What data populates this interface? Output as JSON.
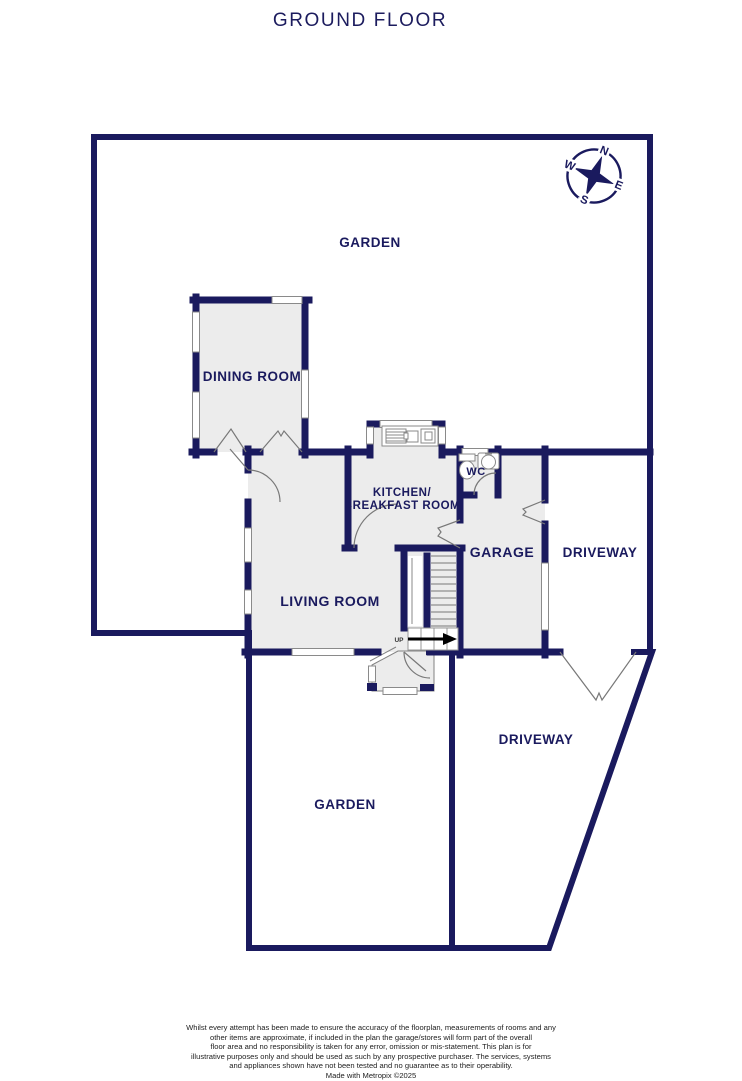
{
  "title": "GROUND FLOOR",
  "colors": {
    "wall": "#1a1a5e",
    "room_fill": "#ececec",
    "thin_line": "#828282",
    "label": "#1a1a5e",
    "arrow": "#000000"
  },
  "compass": {
    "north": "N",
    "east": "E",
    "south": "S",
    "west": "W"
  },
  "rooms": {
    "garden_top": {
      "label": "GARDEN"
    },
    "dining": {
      "label": "DINING ROOM"
    },
    "kitchen": {
      "label_line1": "KITCHEN/",
      "label_line2": "BREAKFAST ROOM"
    },
    "wc": {
      "label": "WC"
    },
    "garage": {
      "label": "GARAGE"
    },
    "driveway_upper": {
      "label": "DRIVEWAY"
    },
    "living": {
      "label": "LIVING ROOM"
    },
    "garden_bottom": {
      "label": "GARDEN"
    },
    "driveway_lower": {
      "label": "DRIVEWAY"
    }
  },
  "stairs": {
    "direction_label": "UP"
  },
  "footer": {
    "lines": [
      "Whilst every attempt has been made to ensure the accuracy of the floorplan, measurements of rooms and any",
      "other items are approximate, if included in the plan the garage/stores will form part of the overall",
      "floor area and no responsibility is taken for any error, omission or mis-statement. This plan is for",
      "illustrative purposes only and should be used as such by any prospective purchaser. The services, systems",
      "and appliances shown have not been tested and no guarantee as to their operability.",
      "Made with Metropix ©2025"
    ]
  }
}
